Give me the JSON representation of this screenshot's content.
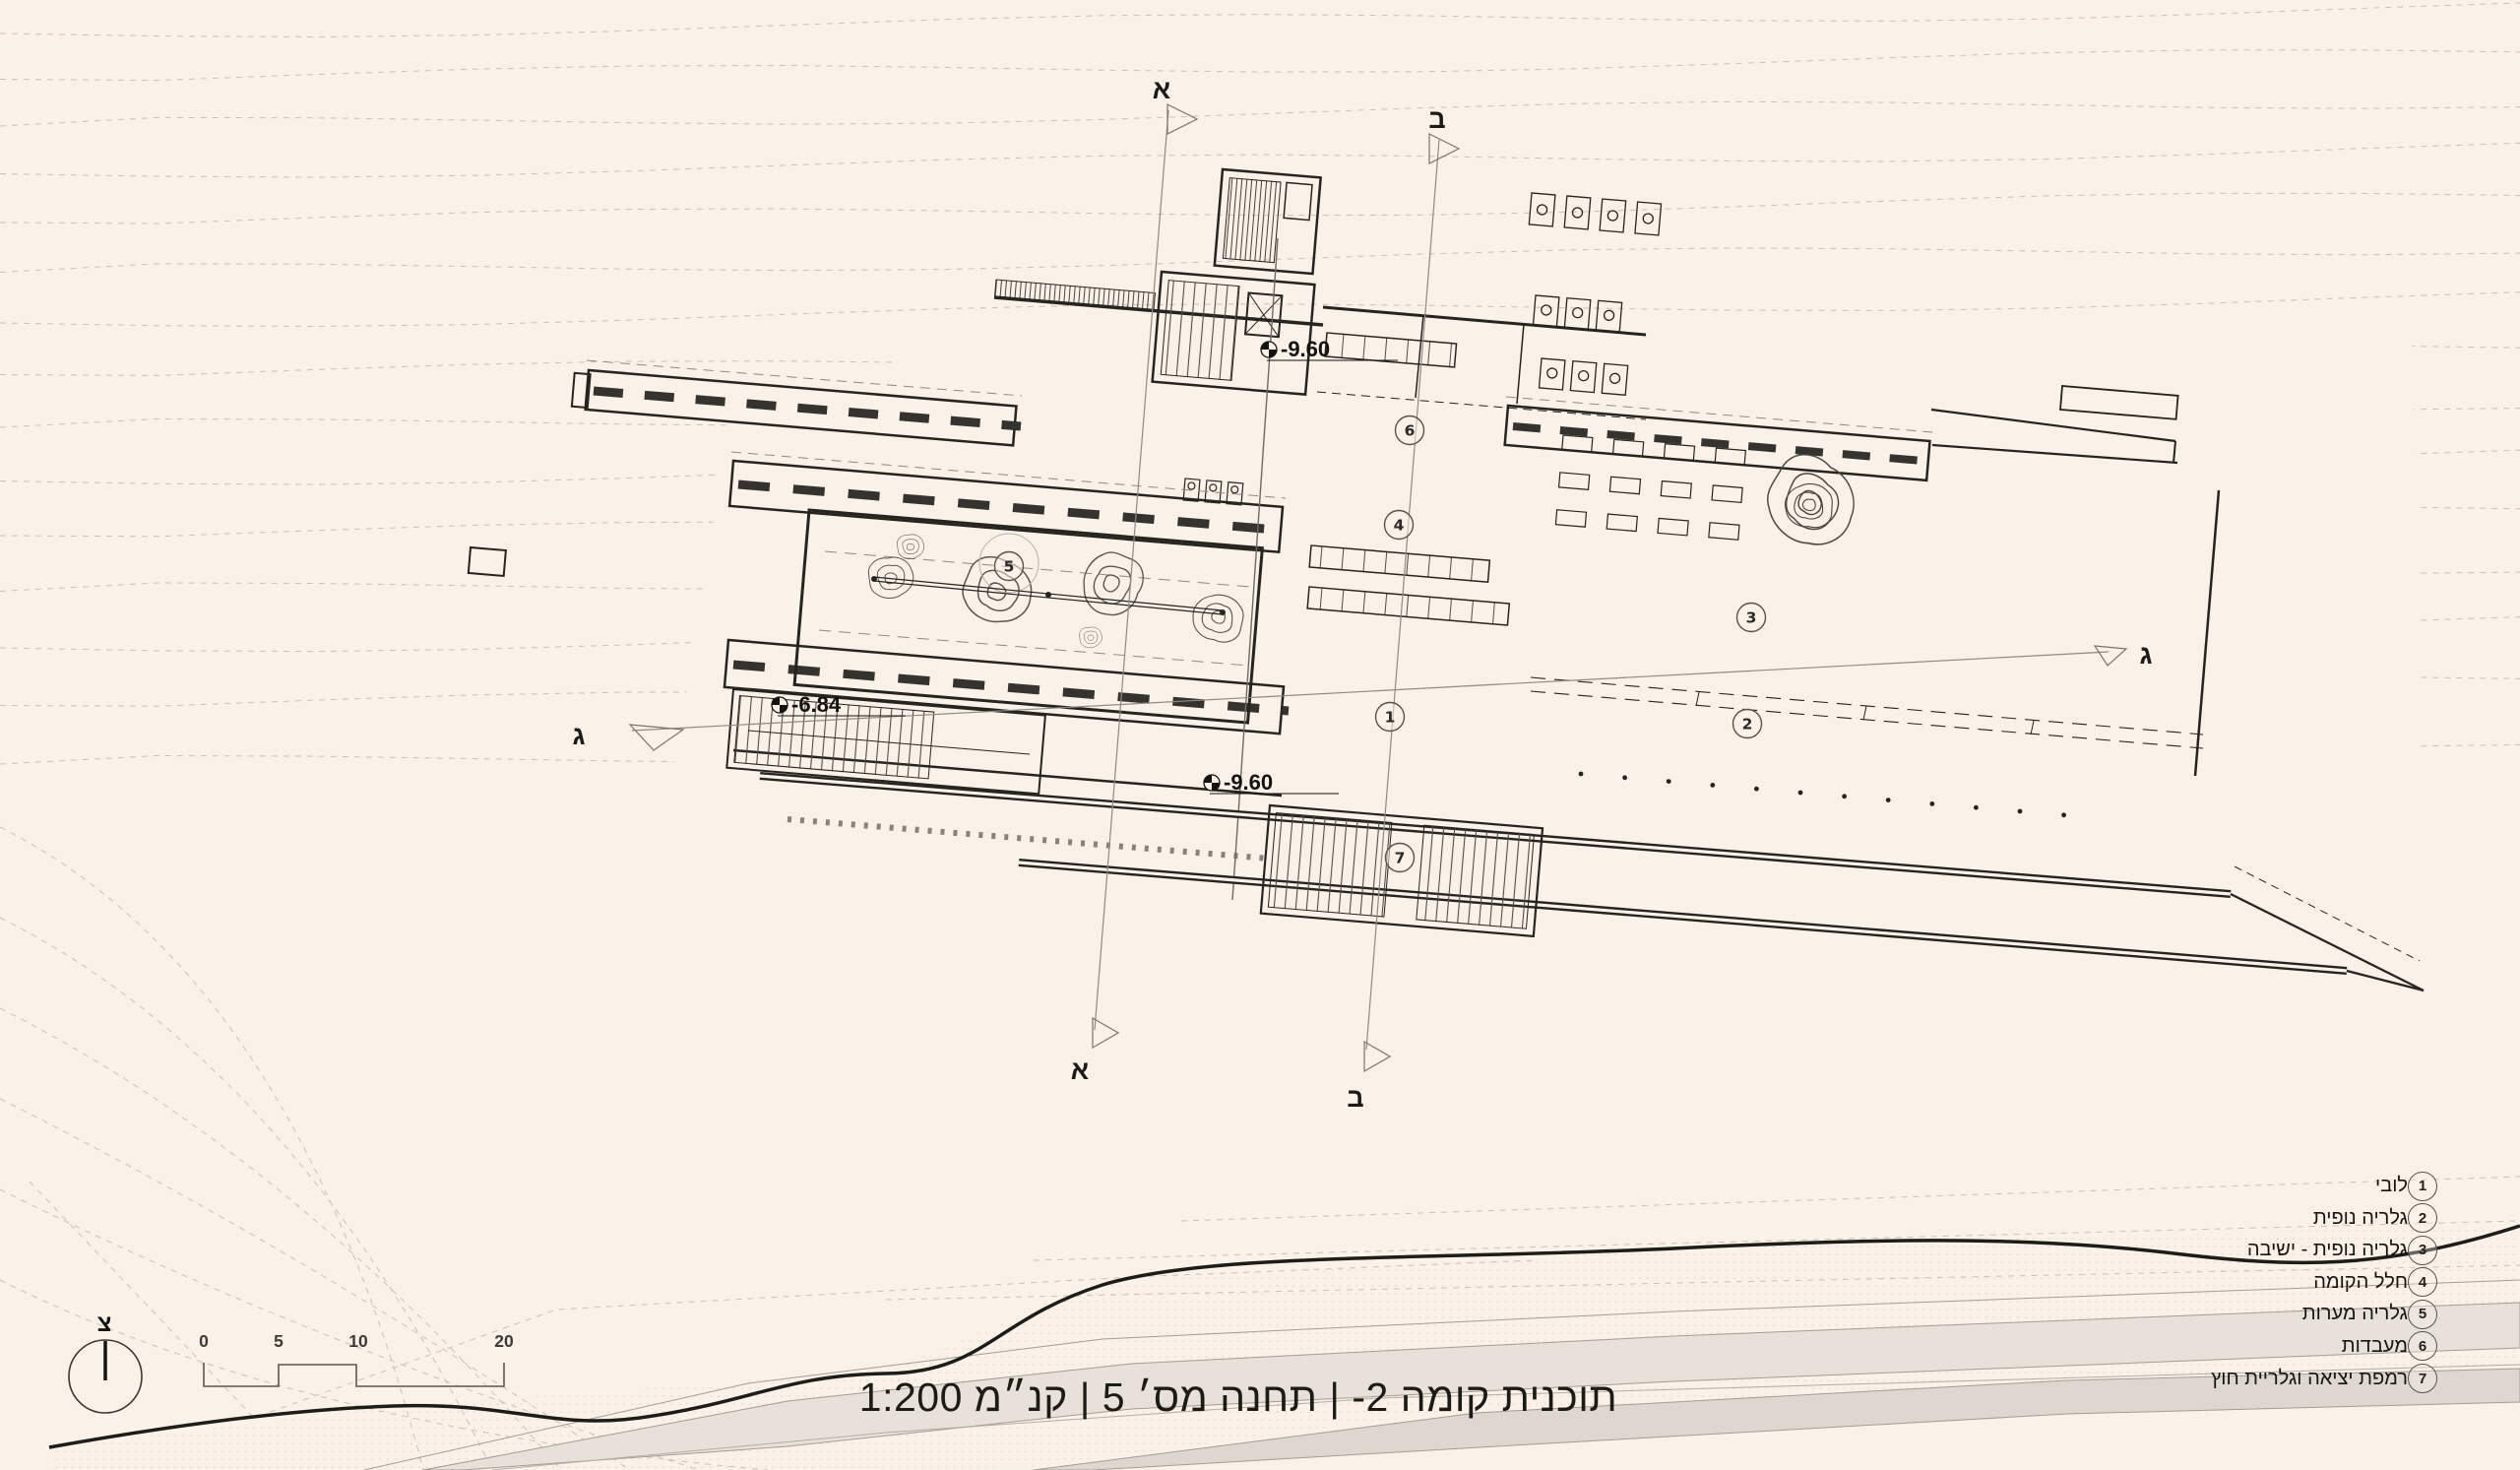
{
  "colors": {
    "background": "#faf1e8",
    "ink": "#26241f",
    "muted_line": "#8f8a83",
    "contour": "#cfc0b4",
    "road_fill": "#e7e1da"
  },
  "title": {
    "text": "תוכנית קומה 2- | תחנה מס׳ 5 | קנ״מ 1:200"
  },
  "legend": {
    "items": [
      {
        "num": "1",
        "label": "לובי"
      },
      {
        "num": "2",
        "label": "גלריה נופית"
      },
      {
        "num": "3",
        "label": "גלריה נופית - ישיבה"
      },
      {
        "num": "4",
        "label": "חלל הקומה"
      },
      {
        "num": "5",
        "label": "גלריה מערות"
      },
      {
        "num": "6",
        "label": "מעבדות"
      },
      {
        "num": "7",
        "label": "רמפת יציאה וגלריית חוץ"
      }
    ]
  },
  "plan": {
    "room_markers": [
      {
        "num": "1"
      },
      {
        "num": "2"
      },
      {
        "num": "3"
      },
      {
        "num": "4"
      },
      {
        "num": "5"
      },
      {
        "num": "6"
      },
      {
        "num": "7"
      }
    ],
    "levels": [
      {
        "value": "-9.60"
      },
      {
        "value": "-6.84"
      },
      {
        "value": "-9.60"
      }
    ],
    "sections": [
      {
        "letter": "א"
      },
      {
        "letter": "ב"
      },
      {
        "letter": "ג"
      }
    ]
  },
  "scalebar": {
    "labels": [
      "0",
      "5",
      "10",
      "20"
    ]
  },
  "compass": {
    "north_label": "צ"
  }
}
